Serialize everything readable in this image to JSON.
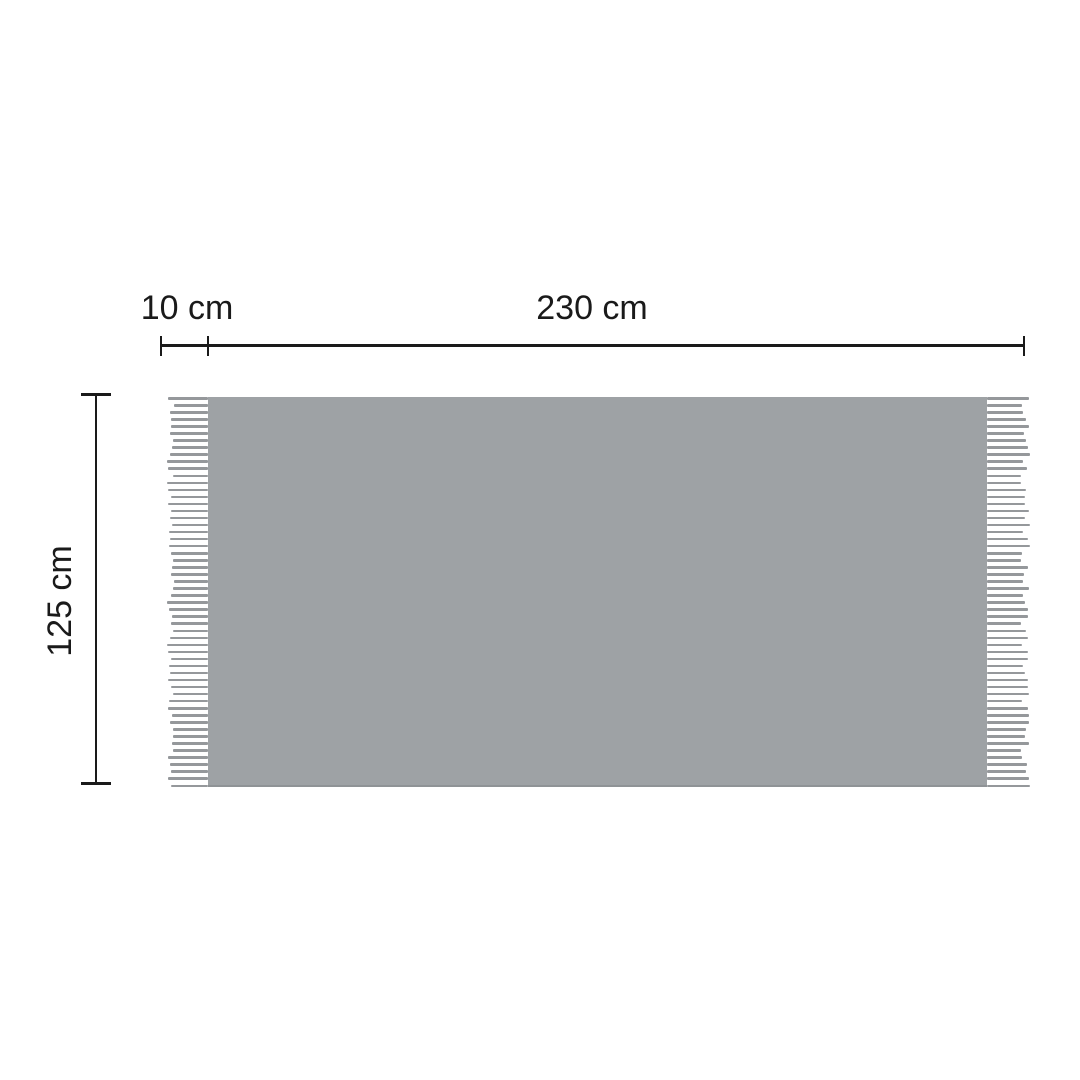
{
  "page": {
    "background": "#ffffff"
  },
  "diagram": {
    "kind": "product-dimension-diagram",
    "product": "fringed-throw-blanket",
    "labels": {
      "fringe_width": "10 cm",
      "body_width": "230 cm",
      "height": "125 cm"
    },
    "colors": {
      "body": "#9ea2a5",
      "body_edge": "#8f9396",
      "fringe": "#95989b",
      "dimension_lines": "#1a1a1a",
      "label_text": "#1a1a1a"
    },
    "fringe": {
      "strokes_per_side": 56,
      "stroke_thickness": 2.5,
      "left_max_length": 41,
      "right_max_length": 43,
      "min_length": 34
    }
  }
}
